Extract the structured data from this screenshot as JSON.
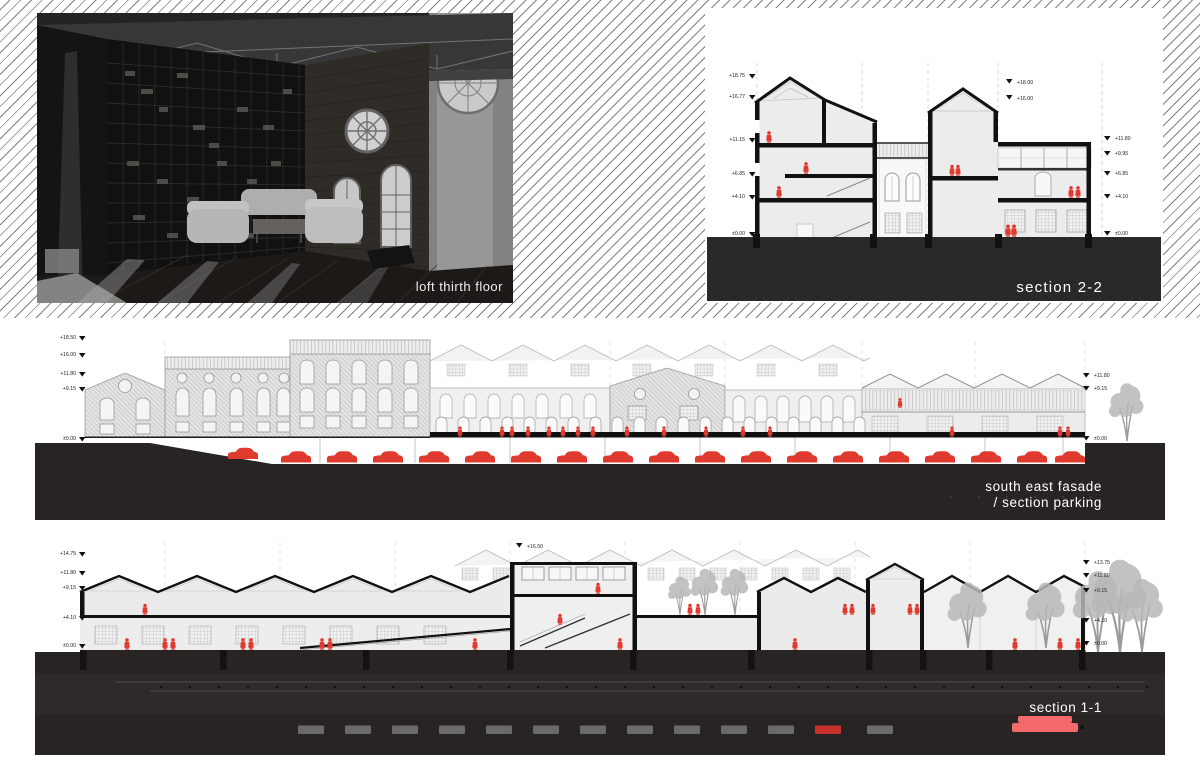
{
  "board": {
    "photo": {
      "caption": "loft thirth floor"
    },
    "section22": {
      "label": "section 2-2",
      "levels_left": [
        "+18.75",
        "+16.77",
        "+11.15",
        "+6.85",
        "+4.10",
        "±0.00"
      ],
      "levels_mid": [
        "+18.00",
        "+16.00"
      ],
      "levels_right": [
        "+11.80",
        "+9.95",
        "+6.85",
        "+4.10",
        "±0.00"
      ]
    },
    "facade": {
      "label_line1": "south east fasade",
      "label_line2": "/ section parking",
      "levels_left": [
        "+18.50",
        "+16.00",
        "+11.80",
        "+9.15",
        "±0.00"
      ],
      "levels_right": [
        "+11.80",
        "+9.15",
        "±0.00"
      ]
    },
    "section11": {
      "label": "section 1-1",
      "level_top": "+16.50",
      "levels_left": [
        "+14.75",
        "+11.80",
        "+9.15",
        "+4.10",
        "±0.00"
      ],
      "levels_right": [
        "+13.75",
        "+11.80",
        "+9.15",
        "+4.10",
        "±0.00"
      ]
    },
    "colors": {
      "accent_red": "#e03a2f",
      "salmon": "#f4696b",
      "ground_dark": "#282424",
      "hatch_line": "#5c5c5c"
    }
  }
}
